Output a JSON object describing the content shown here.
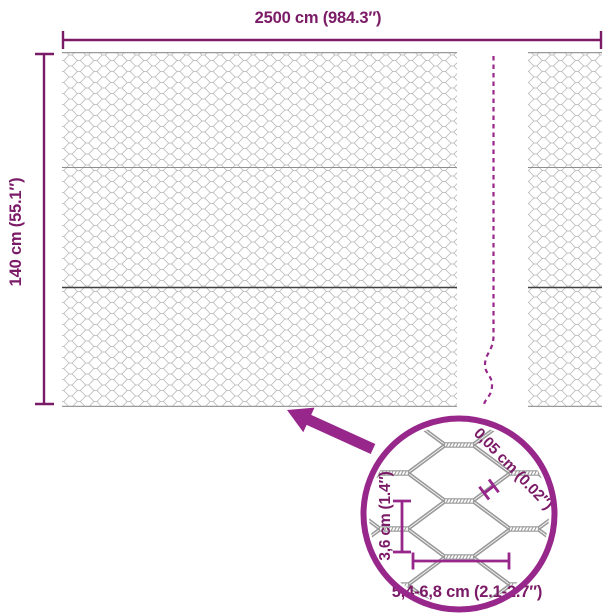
{
  "diagram": {
    "width_label": "2500 cm (984.3″)",
    "height_label": "140 cm (55.1″)",
    "detail": {
      "wire_thickness_label": "0,05 cm (0.02″)",
      "cell_height_label": "3,6 cm (1.4″)",
      "cell_width_label": "5,4-6,8 cm (2.1-2.7″)"
    },
    "colors": {
      "accent": "#97278b",
      "dimension": "#7b1a66",
      "mesh_wire": "#b2b2b2",
      "mesh_detail_wire": "#9a9a9a",
      "mesh_dark_line": "#3f3f3f",
      "mesh_mid_line": "#8f8f8f"
    }
  }
}
